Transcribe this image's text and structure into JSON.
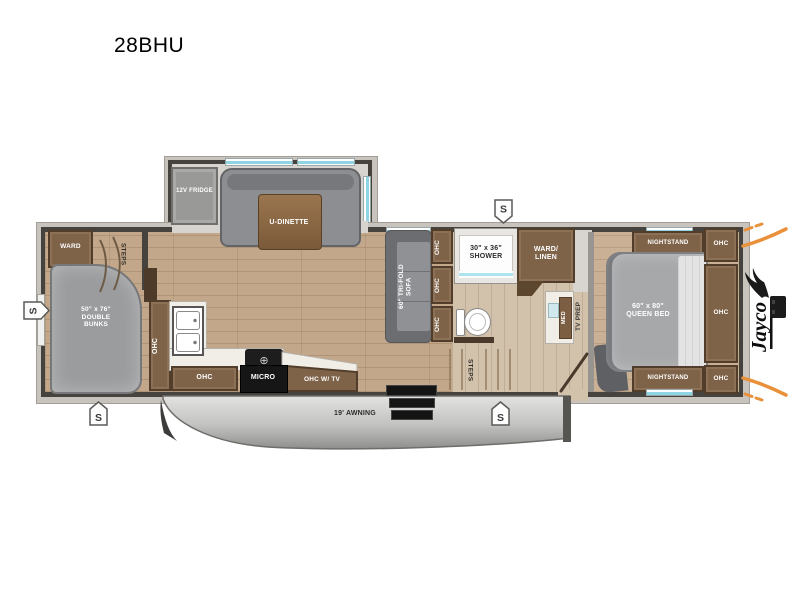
{
  "title": "28BHU",
  "common": {
    "ohc": "OHC",
    "steps": "STEPS",
    "nightstand": "NIGHTSTAND",
    "speaker": "S"
  },
  "slide": {
    "fridge": "12V FRIDGE",
    "dinette": "U-DINETTE"
  },
  "bunk_room": {
    "ward": "WARD",
    "bunks": "50\" x 76\"\nDOUBLE\nBUNKS"
  },
  "kitchen": {
    "micro": "MICRO",
    "ohc_tv": "OHC W/ TV"
  },
  "living": {
    "sofa": "60\" TRI-FOLD\nSOFA"
  },
  "bath": {
    "shower": "30\" x 36\"\nSHOWER",
    "ward_linen": "WARD/\nLINEN",
    "med": "MED"
  },
  "bedroom": {
    "bed": "60\" x 80\"\nQUEEN BED",
    "tv_prep": "TV PREP"
  },
  "exterior": {
    "awning": "19' AWNING",
    "brand": "Jayco"
  },
  "colors": {
    "wall": "#46433f",
    "window_teal": "#8fd4e4",
    "cabinet_brown": "#7e6349",
    "accent_orange": "#e8913a",
    "floor_wood": "#c3a78b",
    "awning_gray": "#bdbdbd"
  }
}
